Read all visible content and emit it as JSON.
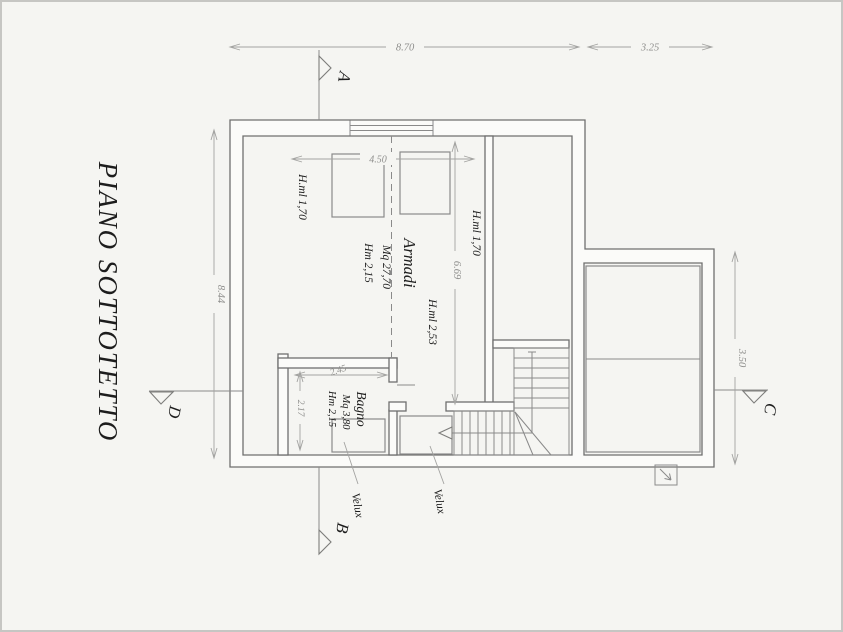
{
  "drawing": {
    "title": "PIANO SOTTOTETTO",
    "dimensions": {
      "overall_width": "8.70",
      "extension_width": "3.25",
      "overall_depth": "8.44",
      "extension_depth": "3.50",
      "armadi_width": "4.50",
      "armadi_depth": "6.69",
      "bagno_width": "2.45",
      "bagno_depth": "2.17"
    },
    "rooms": {
      "armadi": {
        "name": "Armadi",
        "area": "Mq 27,70",
        "height": "Hm 2,15"
      },
      "bagno": {
        "name": "Bagno",
        "area": "Mq 3,80",
        "height": "Hm 2,15"
      }
    },
    "heights": {
      "eaves_left": "H.ml 1,70",
      "eaves_right": "H.ml 1,70",
      "ridge": "H.ml 2,53"
    },
    "skylights": {
      "label_1": "Velux",
      "label_2": "Velux"
    },
    "sections": {
      "a": "A",
      "b": "B",
      "c": "C",
      "d": "D"
    },
    "colors": {
      "wall_line": "#6f6f6f",
      "dim_line": "#a3a3a1",
      "text": "#1d1d1d",
      "background": "#f5f5f2"
    }
  }
}
